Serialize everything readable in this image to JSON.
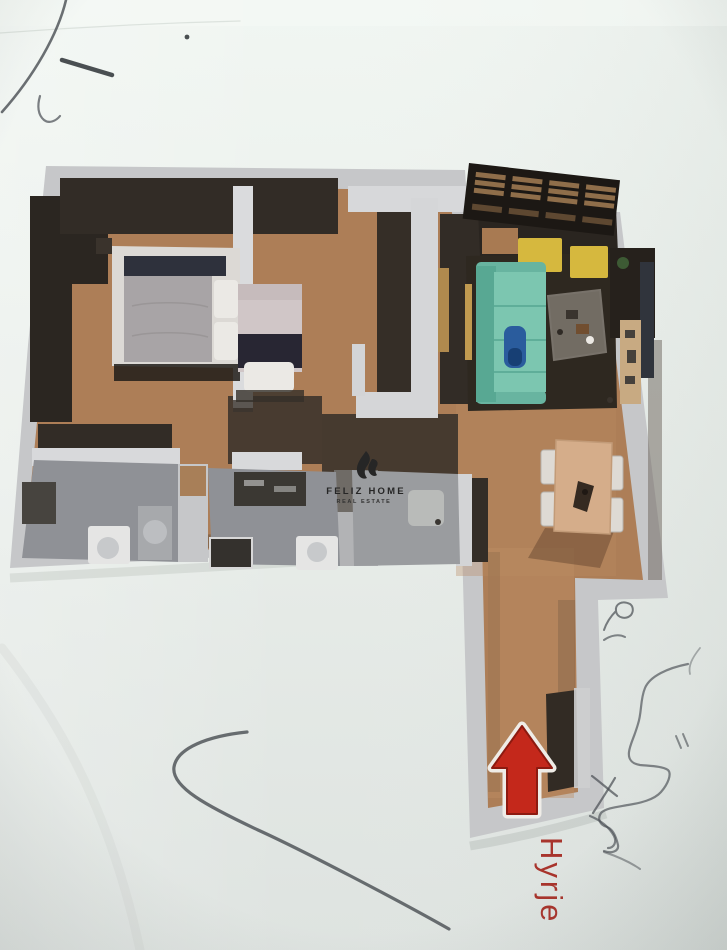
{
  "watermark": {
    "brand": "FELIZ HOME",
    "tagline": "REAL ESTATE",
    "logo_icon": "flame-icon",
    "color": "#262626"
  },
  "entrance": {
    "label": "Hyrje",
    "arrow_icon": "arrow-up-icon",
    "label_color": "#a8342c",
    "arrow_color": "#c4281b"
  },
  "palette": {
    "paper": "#e9eeea",
    "outer_wall": "#c6c7c9",
    "inner_wall_dark": "#322c26",
    "floor_wood": "#ad7e57",
    "bathroom_tile": "#8f9196",
    "sofa_teal": "#7cc6b0",
    "cushion_yellow": "#d6b83e",
    "bed_gray": "#a8a4a6",
    "dining_wood": "#d5ad8a",
    "rug_dark": "#2e2820",
    "pen_ink": "#474c51"
  }
}
